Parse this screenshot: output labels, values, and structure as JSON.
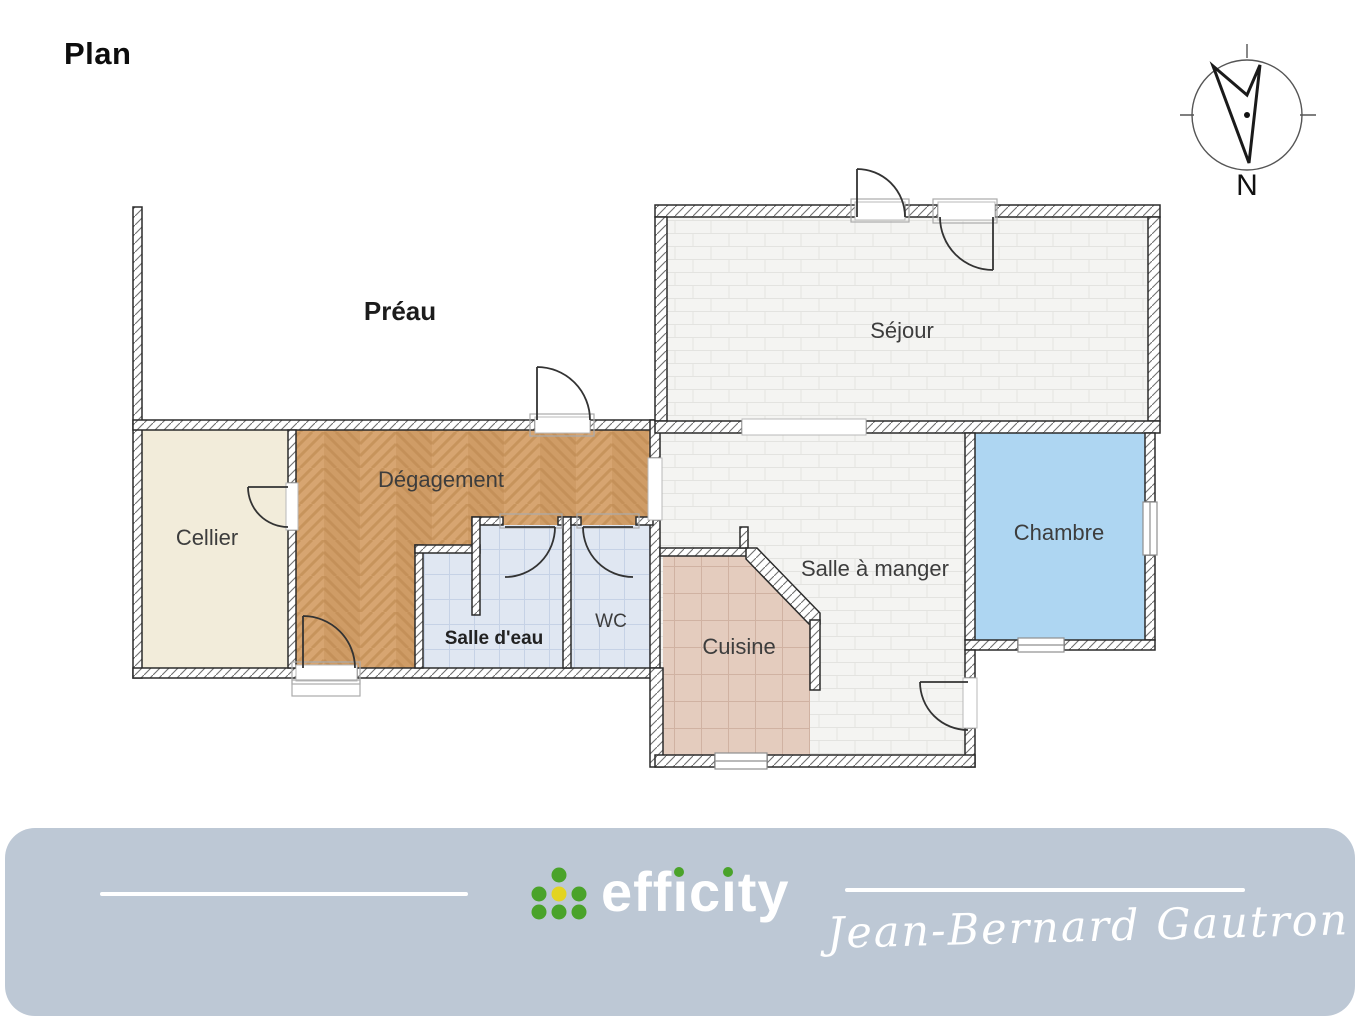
{
  "page": {
    "title": "Plan"
  },
  "compass": {
    "north_label": "N"
  },
  "floor_plan": {
    "rooms": {
      "preau": {
        "label": "Préau"
      },
      "sejour": {
        "label": "Séjour"
      },
      "cellier": {
        "label": "Cellier"
      },
      "degagement": {
        "label": "Dégagement"
      },
      "salle_deau": {
        "label": "Salle d'eau"
      },
      "wc": {
        "label": "WC"
      },
      "cuisine": {
        "label": "Cuisine"
      },
      "salle_a_manger": {
        "label": "Salle à manger"
      },
      "chambre": {
        "label": "Chambre"
      }
    },
    "floor_colors": {
      "cellier": "#f2ecda",
      "degagement_parquet": "#d7a571",
      "salle_deau_wc_tile": "#e0e7f2",
      "cuisine_tile": "#e4ccbe",
      "sejour_salle_a_manger_tile": "#f4f4f2",
      "chambre_carpet": "#aed6f2"
    }
  },
  "footer": {
    "background": "#bdc8d5",
    "brand_name": "efficity",
    "brand_eff": "eff",
    "brand_i": "ı",
    "brand_c": "c",
    "brand_ty": "ty",
    "logo_green": "#4aa32a",
    "logo_yellow": "#e3d422",
    "signature": "Jean-Bernard Gautron"
  }
}
